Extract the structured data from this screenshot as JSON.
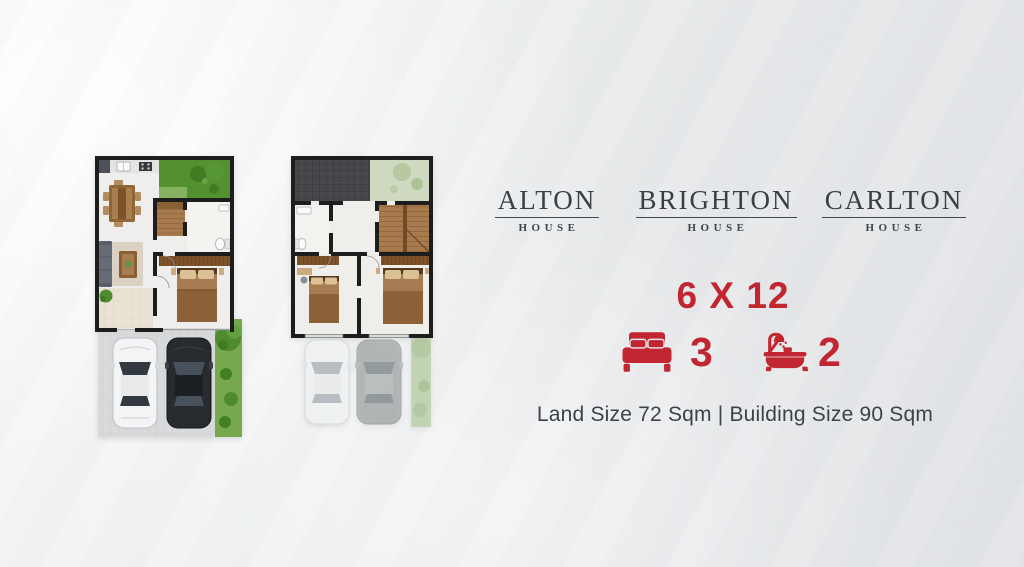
{
  "poster": {
    "houses": [
      {
        "name": "ALTON",
        "label": "HOUSE"
      },
      {
        "name": "BRIGHTON",
        "label": "HOUSE"
      },
      {
        "name": "CARLTON",
        "label": "HOUSE"
      }
    ],
    "specs": {
      "plot_dimensions": "6 X 12",
      "bedrooms": "3",
      "bathrooms": "2",
      "land_building": "Land Size 72 Sqm | Building Size 90 Sqm"
    },
    "icons": {
      "bed": "bed-icon",
      "bath": "bath-icon"
    },
    "floor_plans": [
      {
        "id": "ground-floor-plan",
        "description": "Ground floor: kitchen, dining, living room, bedroom, bathroom, stairs, garden, driveway with two cars"
      },
      {
        "id": "upper-floor-plan",
        "description": "Upper floor: two bedrooms, bathroom, stairs, roof over porch"
      }
    ],
    "colors": {
      "accent_red": "#C2242F",
      "heading_dark": "#383D44",
      "body_text": "#3C4046",
      "background": "#E9EAEC",
      "lawn_green": "#52902D",
      "wall_black": "#1B1B1B"
    }
  }
}
